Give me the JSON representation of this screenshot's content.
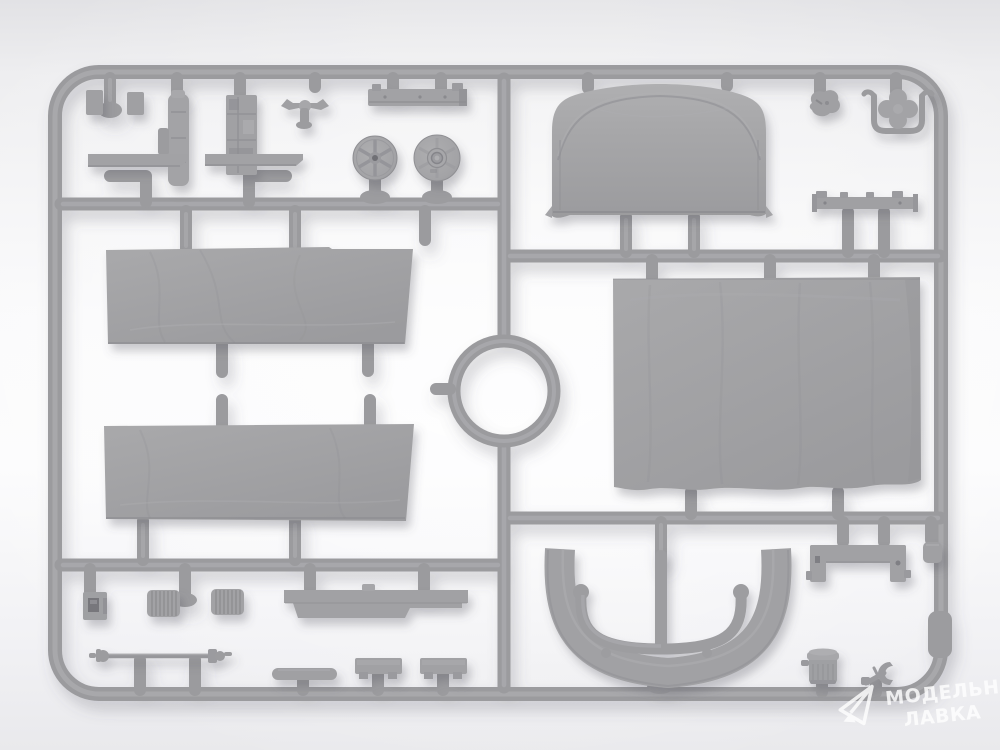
{
  "subject": "Photograph of a gray injection-molded plastic model kit sprue (parts frame) on a bright seamless background",
  "watermark": {
    "line1": "МОДЕЛЬНАЯ",
    "line2": "ЛАВКА",
    "logo": "paper-plane-icon",
    "color": "#ffffff",
    "opacity": 0.82
  },
  "palette": {
    "background_top": "#e3e3e6",
    "background_center": "#fbfbfc",
    "background_bottom": "#e9e9ec",
    "sprue_plastic": "#9c9c9f",
    "sprue_highlight": "#a9a9ac",
    "part_surface": "#a2a2a5",
    "shadow": "rgba(86,86,98,0.30)"
  },
  "objects": [
    "sprue-frame",
    "center-runner-ring",
    "canvas-roof-panel",
    "upper-left-tarpaulin",
    "lower-left-tarpaulin",
    "large-right-tarpaulin",
    "running-board-1",
    "running-board-2",
    "spoked-wheel",
    "hub-wheel",
    "corner-bracket-pair",
    "exhaust-stack",
    "engine-block",
    "steering-linkage",
    "chassis-rail",
    "storage-box",
    "corrugated-muffler-1",
    "corrugated-muffler-2",
    "side-sill",
    "tie-rod-axle",
    "tool-blade",
    "crate-bench-1",
    "crate-bench-2",
    "curved-fender",
    "top-mounting-bracket",
    "bottom-mounting-bracket",
    "small-cube-fitting",
    "canister",
    "wrench",
    "clover-wheel-with-bracket",
    "small-fitting"
  ]
}
